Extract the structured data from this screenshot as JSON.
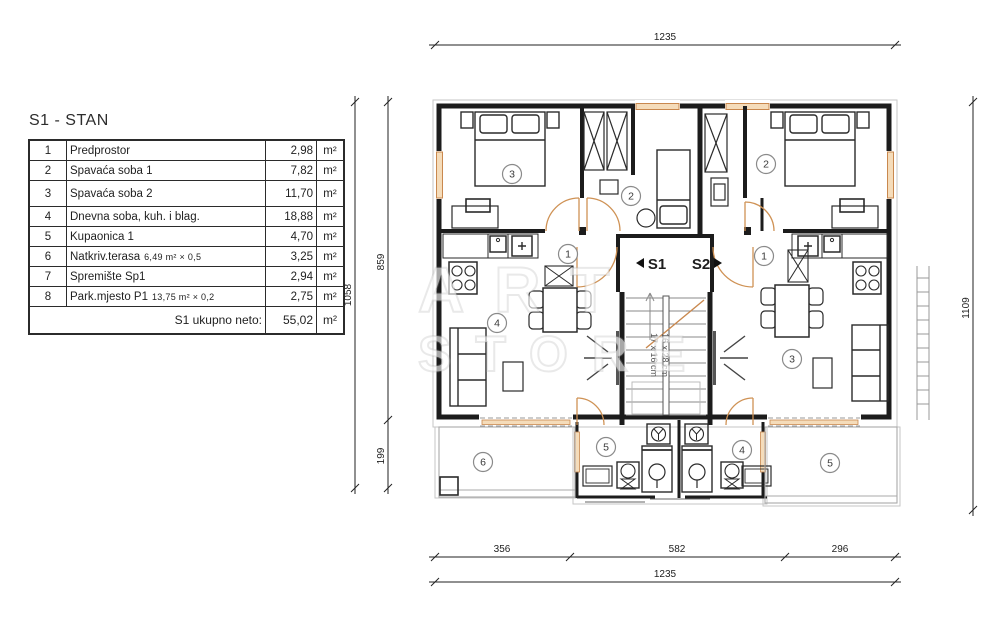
{
  "document": {
    "title": "S1 - STAN"
  },
  "table": {
    "rows": [
      {
        "num": "1",
        "name": "Predprostor",
        "detail": "",
        "area": "2,98",
        "unit": "m²"
      },
      {
        "num": "2",
        "name": "Spavaća soba 1",
        "detail": "",
        "area": "7,82",
        "unit": "m²"
      },
      {
        "num": "3",
        "name": "Spavaća soba 2",
        "detail": "",
        "area": "11,70",
        "unit": "m²"
      },
      {
        "num": "4",
        "name": "Dnevna soba, kuh. i blag.",
        "detail": "",
        "area": "18,88",
        "unit": "m²"
      },
      {
        "num": "5",
        "name": "Kupaonica 1",
        "detail": "",
        "area": "4,70",
        "unit": "m²"
      },
      {
        "num": "6",
        "name": "Natkriv.terasa",
        "detail": "6,49 m²  ×  0,5",
        "area": "3,25",
        "unit": "m²"
      },
      {
        "num": "7",
        "name": "Spremište Sp1",
        "detail": "",
        "area": "2,94",
        "unit": "m²"
      },
      {
        "num": "8",
        "name": "Park.mjesto P1",
        "detail": "13,75 m²  ×  0,2",
        "area": "2,75",
        "unit": "m²"
      }
    ],
    "total": {
      "label": "S1 ukupno neto:",
      "area": "55,02",
      "unit": "m²"
    }
  },
  "plan": {
    "dimensions": {
      "top": "1235",
      "bottom_left": "356",
      "bottom_center": "582",
      "bottom_right": "296",
      "bottom_overall": "1235",
      "left_overall": "1058",
      "left_upper": "859",
      "left_lower": "199",
      "right": "1109"
    },
    "stairwell": {
      "unit_left": "S1",
      "unit_right": "S2",
      "tread_note_1": "17 x 16 cm",
      "tread_note_2": "16 x 28 cm"
    },
    "rooms": {
      "s1_bedroom2": "3",
      "s1_bedroom1": "2",
      "s2_bedroom1": "2",
      "s1_hall": "1",
      "s2_hall": "1",
      "s1_living": "4",
      "s2_living": "3",
      "s1_bath": "5",
      "s2_bath": "4",
      "s1_terrace": "6",
      "s2_terrace": "5"
    }
  },
  "watermark": {
    "line1": "ART",
    "line2": "STORE"
  }
}
